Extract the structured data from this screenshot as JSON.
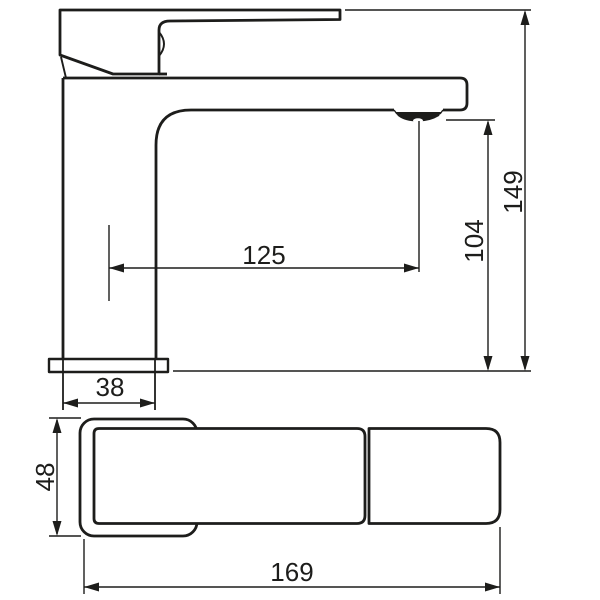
{
  "colors": {
    "line": "#1d1d1b",
    "background": "#ffffff"
  },
  "dimensions": {
    "overall_height": "149",
    "outlet_height": "104",
    "spout_reach": "125",
    "body_depth": "38",
    "base_width": "48",
    "overall_length": "169"
  }
}
